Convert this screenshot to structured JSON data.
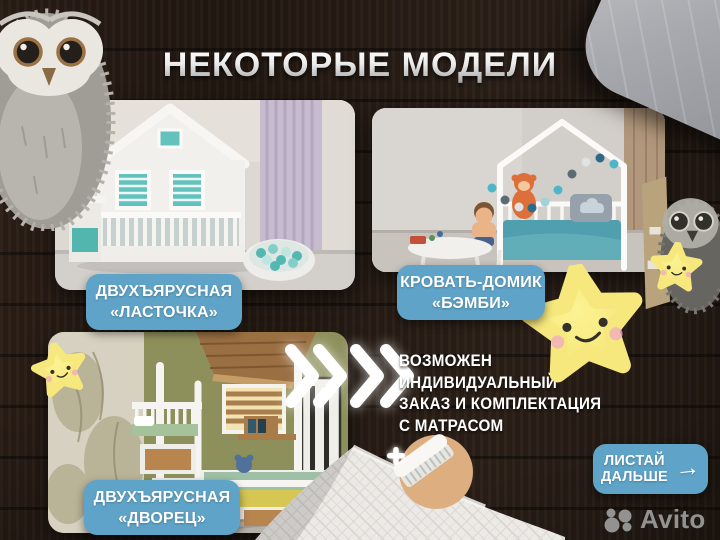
{
  "title": "НЕКОТОРЫЕ МОДЕЛИ",
  "models": [
    {
      "name_line1": "ДВУХЪЯРУСНАЯ",
      "name_line2": "«ЛАСТОЧКА»"
    },
    {
      "name_line1": "КРОВАТЬ-ДОМИК",
      "name_line2": "«БЭМБИ»"
    },
    {
      "name_line1": "ДВУХЪЯРУСНАЯ",
      "name_line2": "«ДВОРЕЦ»"
    }
  ],
  "note_lines": [
    "ВОЗМОЖЕН",
    "ИНДИВИДУАЛЬНЫЙ",
    "ЗАКАЗ И КОМПЛЕКТАЦИЯ",
    "С МАТРАСОМ"
  ],
  "next_button": {
    "line1": "ЛИСТАЙ",
    "line2": "ДАЛЬШЕ",
    "arrow": "→"
  },
  "watermark": "Avito",
  "colors": {
    "badge_blue": "#5fa4c8",
    "star_yellow": "#f7e87d",
    "background_wood": "#261b14",
    "title_silver": "#ececec",
    "watermark_gray": "#9d9d9d"
  }
}
